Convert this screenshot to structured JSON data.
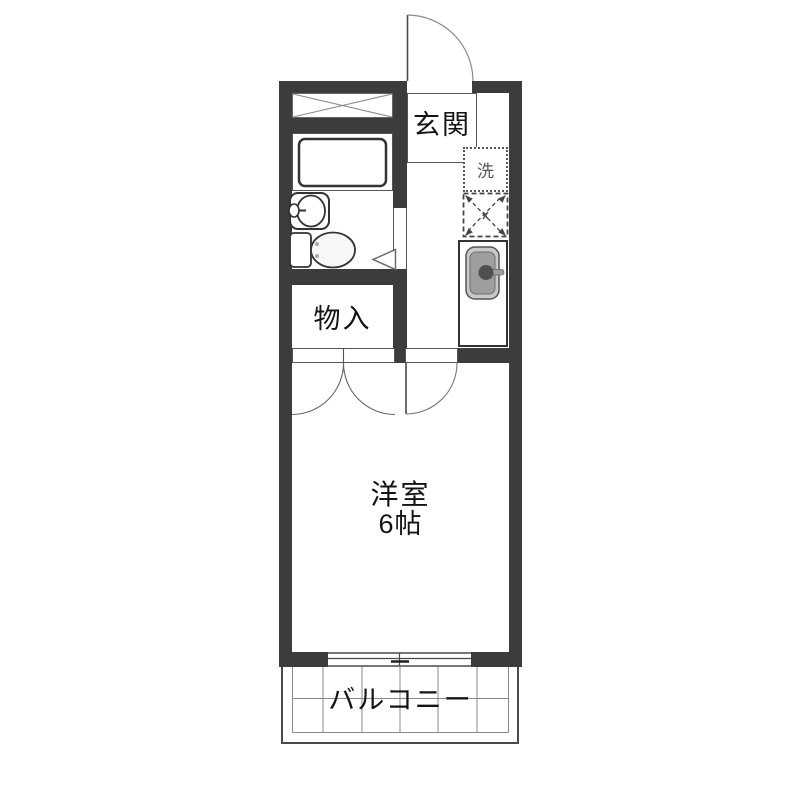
{
  "plan": {
    "labels": {
      "entrance": "玄関",
      "washer": "洗",
      "closet": "物入",
      "room": "洋室",
      "room_size": "6帖",
      "balcony": "バルコニー"
    },
    "colors": {
      "wall": "#3c3c3c",
      "thin_line": "#4a4a4a",
      "grid_line": "#888888",
      "sink_outer": "#c8c8c8",
      "sink_basin": "#9e9e9e",
      "faucet": "#4f4f4f",
      "text": "#141414",
      "washer_text": "#555555",
      "background": "#ffffff"
    }
  }
}
